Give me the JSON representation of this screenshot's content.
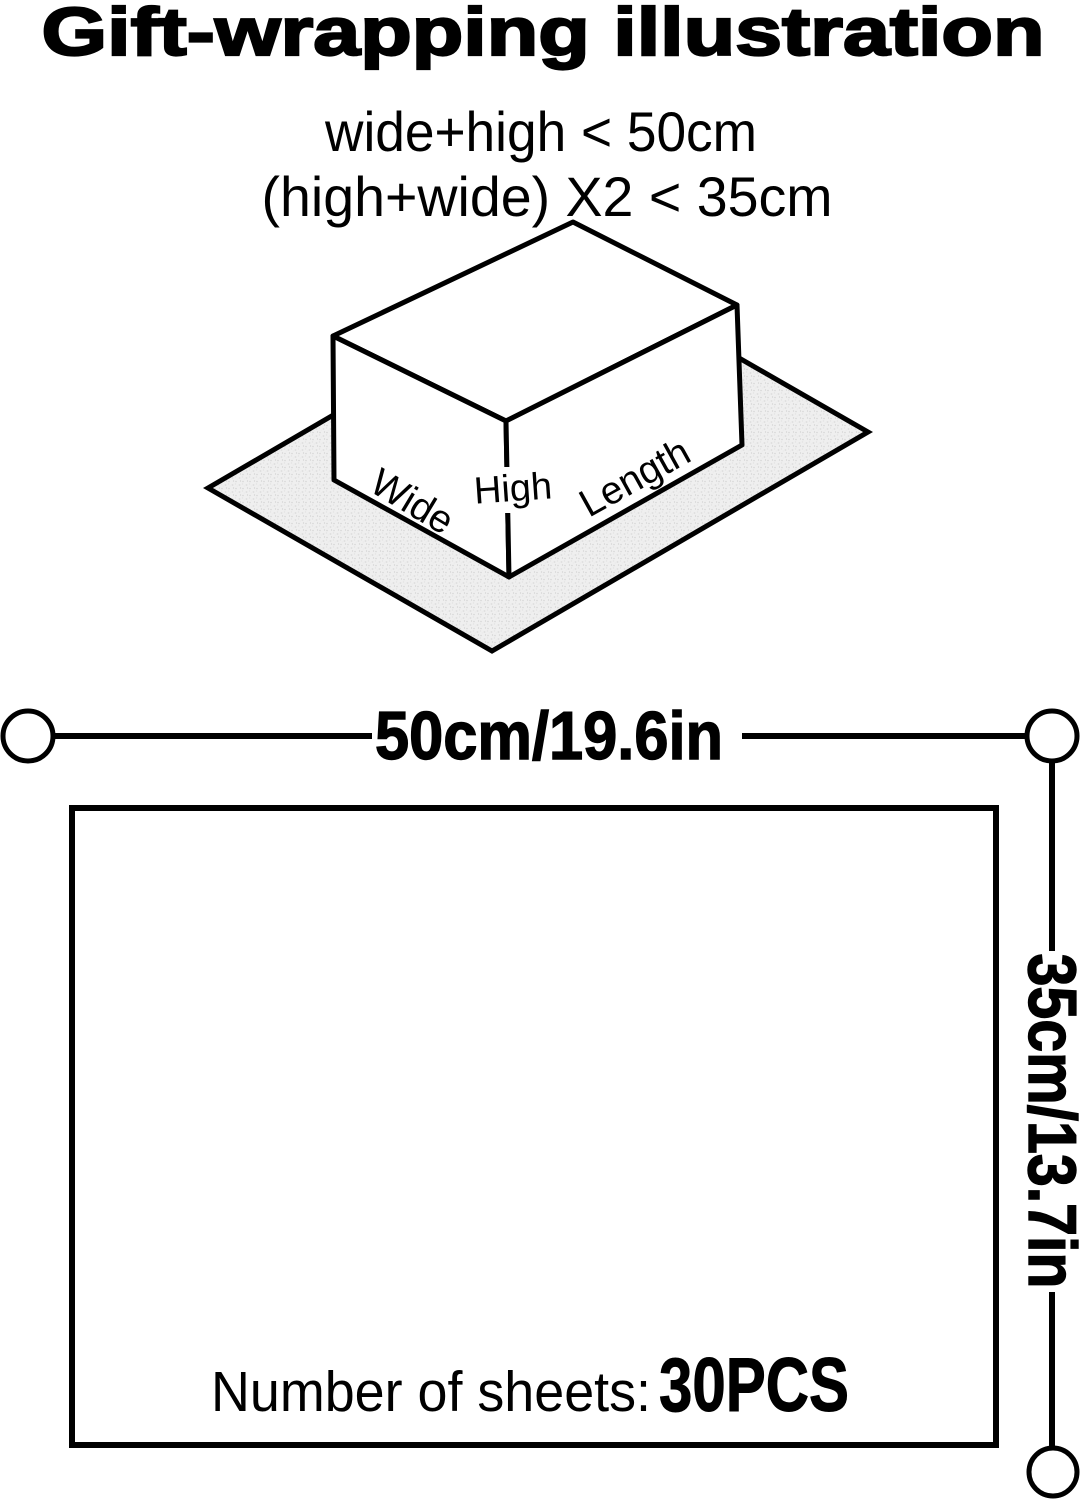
{
  "title": "Gift-wrapping illustration",
  "conditions": {
    "line1": "wide+high < 50cm",
    "line2": "(high+wide) X2 < 35cm"
  },
  "box": {
    "wide": "Wide",
    "high": "High",
    "length": "Length"
  },
  "sheet": {
    "width_label": "50cm/19.6in",
    "height_label": "35cm/13.7in",
    "count_label": "Number of sheets:",
    "count_value": "30PCS"
  },
  "colors": {
    "ink": "#000000",
    "paper_fill": "#efefef",
    "paper_speckle": "#d6d6d6",
    "background": "#ffffff"
  }
}
